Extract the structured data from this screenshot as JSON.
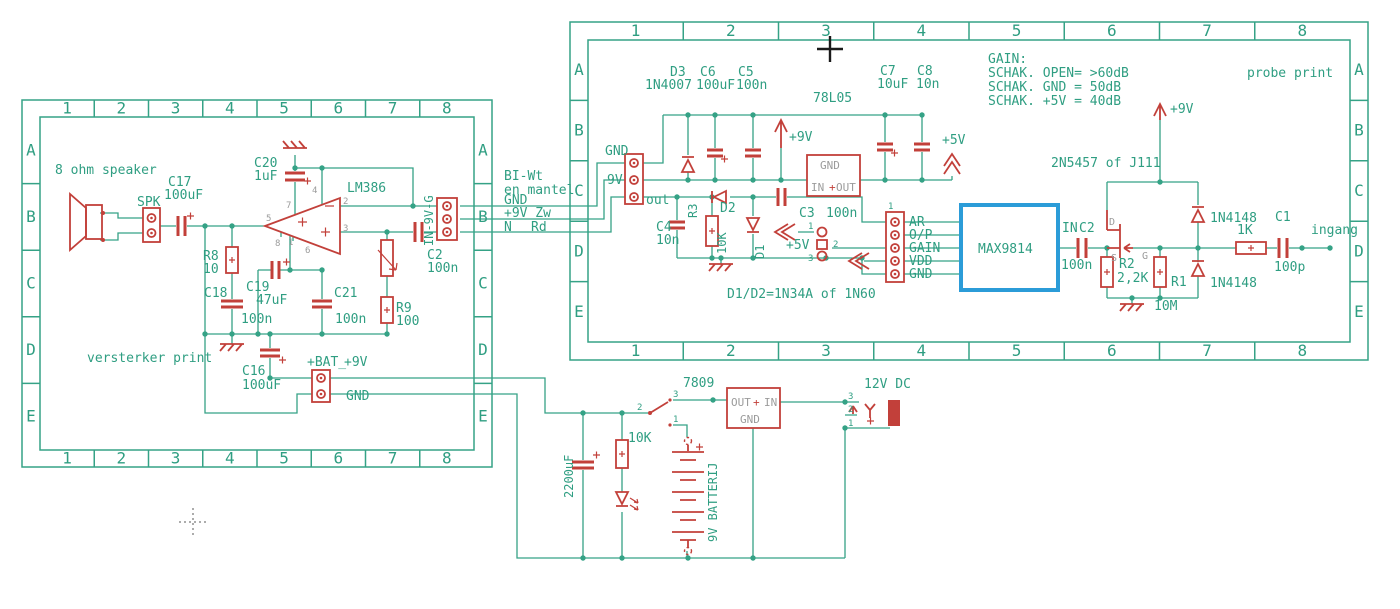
{
  "frame": {
    "cols": [
      "1",
      "2",
      "3",
      "4",
      "5",
      "6",
      "7",
      "8"
    ],
    "rows": [
      "A",
      "B",
      "C",
      "D",
      "E"
    ]
  },
  "colors": {
    "trace": "#35a286",
    "component": "#c2403a",
    "ic_highlight": "#2b9cd8",
    "pin_text": "#9b9b9b"
  },
  "lb": {
    "title": "versterker print",
    "speaker": "8 ohm speaker",
    "spk": "SPK",
    "c17": "C17",
    "c17v": "100uF",
    "c20": "C20",
    "c20v": "1uF",
    "opamp": "LM386",
    "r8": "R8",
    "r8v": "10",
    "c18": "C18",
    "c18v": "100n",
    "c19": "C19",
    "c19v": "47uF",
    "c21": "C21",
    "c21v": "100n",
    "r9": "R9",
    "r9v": "100",
    "c2": "C2",
    "c2v": "100n",
    "c16": "C16",
    "c16v": "100uF",
    "bat": "+BAT_",
    "bat9": "+9V",
    "gnd": "GND",
    "conn": "IN-9V-G",
    "p5": "5",
    "p7": "7",
    "p4": "4",
    "p2": "2",
    "p3": "3",
    "p6": "6",
    "p8": "8",
    "p1": "1"
  },
  "cable": {
    "l1": "BI-Wt",
    "l2": "en mantel",
    "l3": "GND",
    "l4": "+9V Zw",
    "l5": "N",
    "l6": "Rd"
  },
  "rb": {
    "title": "probe print",
    "gain_title": "GAIN:",
    "gain1": "SCHAK. OPEN= >60dB",
    "gain2": "SCHAK. GND = 50dB",
    "gain3": "SCHAK. +5V = 40dB",
    "d3": "D3",
    "d3v": "1N4007",
    "c6": "C6",
    "c6v": "100uF",
    "c5": "C5",
    "c5v": "100n",
    "reg": "78L05",
    "reg_gnd": "GND",
    "reg_in": "IN",
    "reg_out": "OUT",
    "reg_plus": "+",
    "c7": "C7",
    "c7v": "10uF",
    "c8": "C8",
    "c8v": "10n",
    "p9v": "+9V",
    "p5v": "+5V",
    "p9v2": "+9V",
    "p5v2": "+5V",
    "conn_gnd": "GND",
    "conn_9v": "9V",
    "conn_out": "out",
    "d2": "D2",
    "d1": "D1",
    "dnote": "D1/D2=1N34A of 1N60",
    "r3": "R3",
    "r3v": "10K",
    "c4": "C4",
    "c4v": "10n",
    "c3": "C3",
    "c3v": "100n",
    "j1": "1",
    "j2": "2",
    "j3": "3",
    "hdr1": "AR",
    "hdr2": "O/P",
    "hdr3": "GAIN",
    "hdr4": "VDD",
    "hdr5": "GND",
    "hdr_pin": "1",
    "ic": "MAX9814",
    "in_net": "IN",
    "c2": "C2",
    "c2v": "100n",
    "fet": "2N5457 of J111",
    "fd": "D",
    "fs": "S",
    "fg": "G",
    "d4": "1N4148",
    "d5": "1N4148",
    "r1": "R1",
    "r1v": "10M",
    "r2": "R2",
    "r2v": "2,2K",
    "r4": "1K",
    "c1": "C1",
    "c1v": "100p",
    "ingang": "ingang"
  },
  "psu": {
    "reg": "7809",
    "reg_out": "OUT",
    "reg_plus": "+",
    "reg_in": "IN",
    "reg_gnd": "GND",
    "cap": "2200uF",
    "res": "10K",
    "battery": "9V BATTERIJ",
    "jack": "12V DC",
    "sw1": "1",
    "sw2": "2",
    "sw3": "3",
    "jk1": "1",
    "jk2": "2",
    "jk3": "3"
  }
}
